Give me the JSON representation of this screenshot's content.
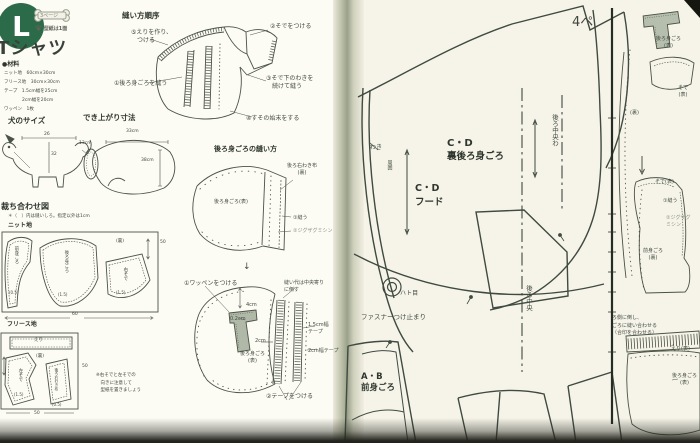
{
  "left_page": {
    "badge": {
      "letter": "L",
      "bone_label": "3ページ",
      "pattern_note": "型紙は1面"
    },
    "title": "Tシャツ",
    "materials": {
      "heading": "●材料",
      "items": [
        "ニット地　60cm×30cm",
        "フリース地　30cm×30cm",
        "テープ　1.5cm幅を25cm",
        "　　　　2cm幅を20cm",
        "ワッペン　1枚"
      ]
    },
    "dog_size": {
      "heading": "犬のサイズ",
      "back_length": "26",
      "girth": "32"
    },
    "finished_size": {
      "heading": "でき上がり寸法",
      "width": "33cm",
      "neck": "13cm",
      "length": "38cm"
    },
    "sewing_order": {
      "heading": "縫い方順序",
      "step5_l1": "⑤えりを作り、",
      "step5_l2": "　つける",
      "step1": "①後ろ身ごろを縫う",
      "step2": "②そでをつける",
      "step3_l1": "③そで下のわきを",
      "step3_l2": "　続けて縫う",
      "step4": "④すその始末をする"
    },
    "back_body": {
      "heading": "後ろ身ごろの縫い方",
      "side_piece_l1": "後ろ右わき布",
      "side_piece_l2": "(裏)",
      "main_piece": "後ろ身ごろ(表)",
      "sew": "①縫う",
      "zigzag": "②ジグザグミシン"
    },
    "patch_diagram": {
      "attach_patch": "①ワッペンをつける",
      "fold_note_l1": "縫い代は中央寄り",
      "fold_note_l2": "に倒す",
      "m_4cm": "4cm",
      "m_02cm": "0.2cm",
      "m_2cm": "2cm",
      "tape15_l1": "1.5cm幅",
      "tape15_l2": "テープ",
      "tape2": "2cm幅テープ",
      "body_l1": "後ろ身ごろ",
      "body_l2": "(表)",
      "attach_tape": "②テープをつける",
      "down_arrow": "↓"
    },
    "cutting": {
      "heading": "裁ち合わせ図",
      "note": "＊（　）内は縫いしろ。指定以外は1cm",
      "knit": {
        "label": "ニット地",
        "front": "前身ごろ",
        "front_sa": "(0.5)",
        "back": "後ろ身ごろ",
        "back_sa": "(1.5)",
        "sleeve_r": "右そで",
        "sleeve_r_sa": "(1.5)",
        "wrong_side": "(裏)",
        "width": "60",
        "height": "50"
      },
      "fleece": {
        "label": "フリース地",
        "collar": "えり",
        "wrong_side": "(裏)",
        "sleeve_l": "左そで",
        "sleeve_l_sa": "(1.5)",
        "side_piece": "後ろ右わき布",
        "side_piece_sa": "(0.5)",
        "width": "50",
        "height": "50",
        "note_l1": "※右そでと左そでの",
        "note_l2": "　向きに注意して",
        "note_l3": "　型紙を置きましょう"
      }
    }
  },
  "right_page": {
    "page_marker": "4ペ",
    "labels": {
      "waki": "わき",
      "face_edge": "周囲",
      "back_cd": "C・D",
      "back_name": "裏後ろ身ごろ",
      "hood_cd": "C・D",
      "hood_name": "フード",
      "center_back_fold": "後ろ中央わ",
      "center_back": "後ろ中央",
      "eyelet": "ハト目",
      "zipper_stop": "ファスナーつけ止まり",
      "front_ab": "A・B",
      "front_name": "前身ごろ"
    }
  },
  "next_page": {
    "patch_body_l1": "後ろ身ごろ",
    "patch_body_l2": "(表)",
    "sleeve_l1": "そで",
    "sleeve_l2": "(表)",
    "wrong": "(裏)",
    "down_arrow": "↓",
    "sleeve2": "そで(表)",
    "sew": "①縫う",
    "zigzag_l1": "②ジグザグ",
    "zigzag_l2": "ミシン",
    "front_l1": "前身ごろ",
    "front_l2": "(裏)",
    "note_l1": "ろ側に倒し、",
    "note_l2": "ごろに縫い合わせる",
    "note_l3": "（合印を合わせる）",
    "collar": "えり(表)",
    "body_l1": "後ろ身ごろ",
    "body_l2": "(表)"
  }
}
